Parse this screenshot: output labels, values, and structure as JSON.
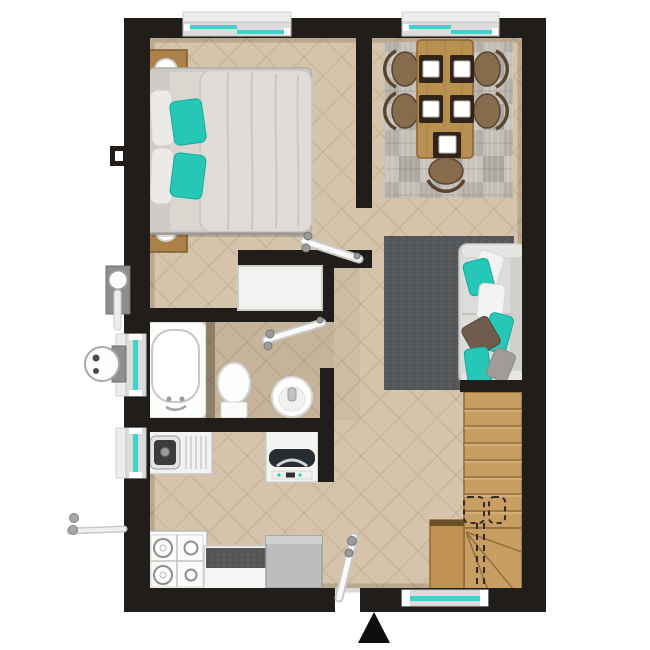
{
  "scene": {
    "type": "apartment floor plan, top-down 3D render",
    "background": "white",
    "entrance_marker": "black triangle arrow pointing up at bottom center"
  },
  "palette": {
    "wall": "#211d1a",
    "floor": "#d5c4ab",
    "floor_line": "#c2b094",
    "window_glass": "#3fd4cb",
    "window_frame": "#dcdcdc",
    "window_sill": "#ededeb",
    "teal_accent": "#27c7b8",
    "teal_dark": "#16a89b",
    "wood": "#ab8149",
    "wood_dark": "#7c5a30",
    "table_wood": "#b8904f",
    "stair_wood": "#c89e63",
    "stair_line": "#936f3f",
    "sofa_gray": "#dcdcda",
    "living_rug": "#54585b",
    "dining_rug": "#bab6af",
    "fixture_white": "#fdfdfc",
    "counter_granite": "#565656",
    "cabinet_gray": "#bcbdbe",
    "pillow_brown": "#6f5c4c",
    "pillow_gray": "#a09d98",
    "duvet": "#dfdcd7",
    "arrow": "#0e0e0e"
  },
  "rooms": [
    {
      "name": "bedroom",
      "position": "top-left",
      "items": [
        "double bed",
        "gray duvet",
        "2 teal pillows",
        "2 white pillows",
        "2 wooden nightstands",
        "2 round table lamps",
        "white closet box"
      ]
    },
    {
      "name": "dining area",
      "position": "top-right",
      "items": [
        "wooden table",
        "5 rattan chairs",
        "5 dark placemats with white plates",
        "patchwork gray rug"
      ]
    },
    {
      "name": "living area",
      "position": "right-middle",
      "items": [
        "light gray sofa",
        "teal, white, brown and gray cushions",
        "dark speckled rug"
      ]
    },
    {
      "name": "bathroom",
      "position": "left-middle",
      "items": [
        "bathtub",
        "toilet",
        "round washbasin"
      ]
    },
    {
      "name": "kitchen",
      "position": "bottom-left",
      "items": [
        "sink with drainboard",
        "washing machine",
        "4-burner gas stove",
        "counter with dark worktop"
      ]
    },
    {
      "name": "entry",
      "position": "bottom-center",
      "items": [
        "entrance door leaf",
        "gray cabinet cube"
      ]
    },
    {
      "name": "staircase",
      "position": "bottom-right",
      "items": [
        "wooden straight flight",
        "winder turn",
        "dashed walk line",
        "2 dashed landing squares",
        "side landing block"
      ]
    }
  ],
  "windows": [
    "bedroom top wall",
    "dining top wall",
    "bathroom left wall",
    "kitchen left wall",
    "stairs bottom wall"
  ],
  "doors": [
    "bedroom door (open white leaf)",
    "bathroom door (open white leaf)",
    "entrance door (open white leaf)"
  ],
  "exterior_fixtures": [
    "wall vent box on left wall",
    "water heater plate with pipe",
    "round gas meter",
    "gas stub pipe with valves",
    "entrance arrow"
  ]
}
